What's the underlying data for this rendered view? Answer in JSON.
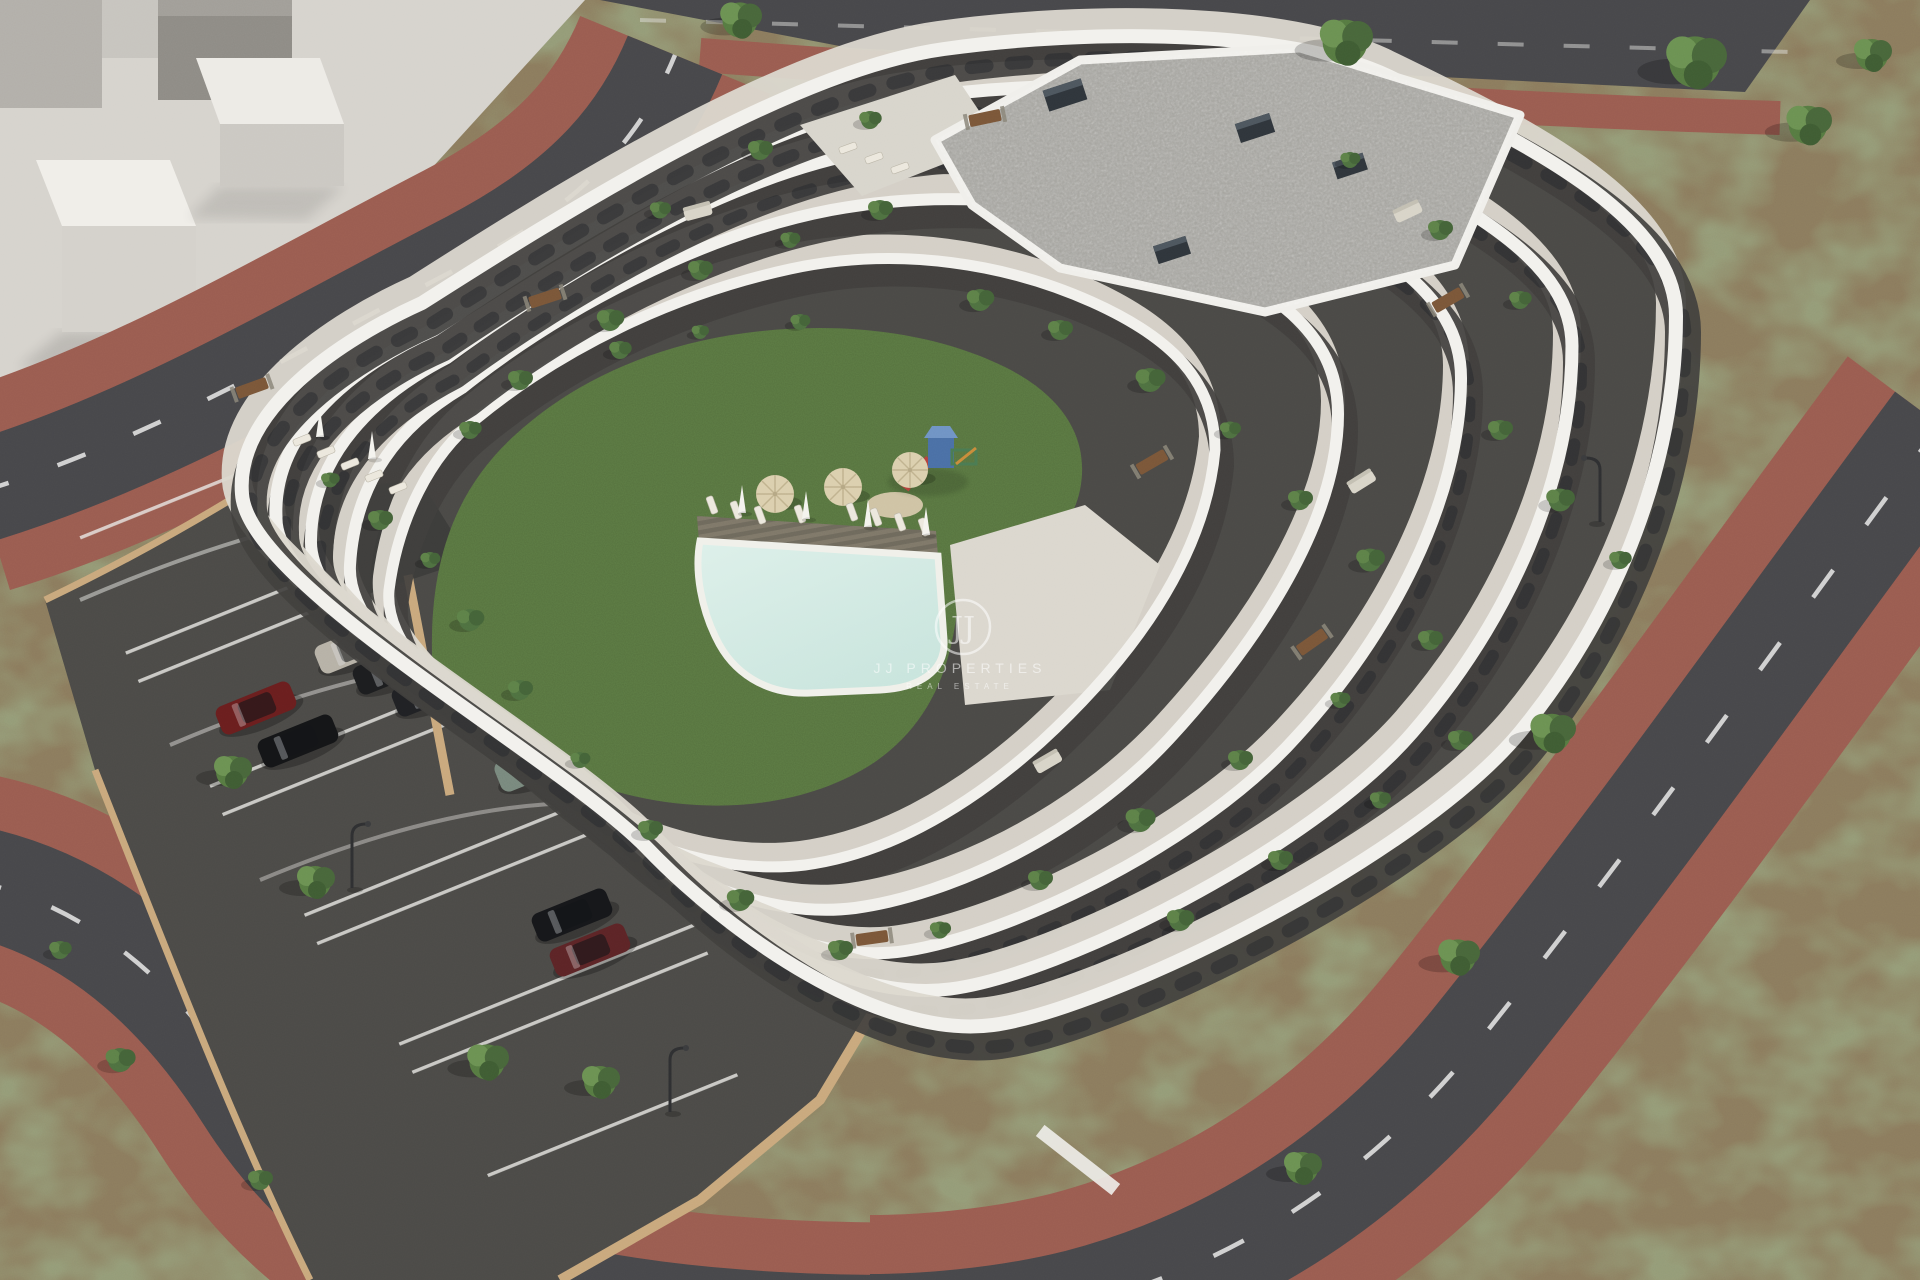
{
  "scene": {
    "type": "3d-architectural-aerial-render",
    "description": "Daylight aerial 3D rendering of a white terraced apartment complex with wavy balcony bands, a central courtyard with lawn, swimming pool, sun deck, umbrellas and playground, an open-air parking lot with cars, surrounding asphalt streets with red paved sidewalks, bare earth plots and scattered trees, and an abstract light-grey neighbouring building massing in the top-left corner."
  },
  "watermark": {
    "monogram": "JJ",
    "title": "JJ PROPERTIES",
    "subtitle": "REAL ESTATE"
  },
  "site": {
    "tan_pool_umbrellas": 3,
    "white_folded_umbrellas": 6,
    "parked_cars": 8,
    "has_playground": true,
    "has_pool": true,
    "street_trees": 9
  },
  "palette": {
    "dirt": "#8b7b5d",
    "plaza": "#d6d3cd",
    "asphalt": "#47474a",
    "parking-asphalt": "#4b4a47",
    "sidewalk-red": "#9a5c50",
    "lane-white": "#e9e9e7",
    "building-white": "#f2f1ed",
    "terrace-floor": "#dbd7ce",
    "wall-dark": "#403f3d",
    "window-dark": "#26282b",
    "roof-gravel": "#a3a29d",
    "lawn": "#55713e",
    "pool-water": "#c9e5dd",
    "pool-rim": "#f0f0ea",
    "deck-wood": "#6e695c",
    "sand": "#cfc3a4",
    "tan-wall": "#c9a87c",
    "umbrella-tan": "#dbcfae",
    "watermark": "#ffffff"
  }
}
